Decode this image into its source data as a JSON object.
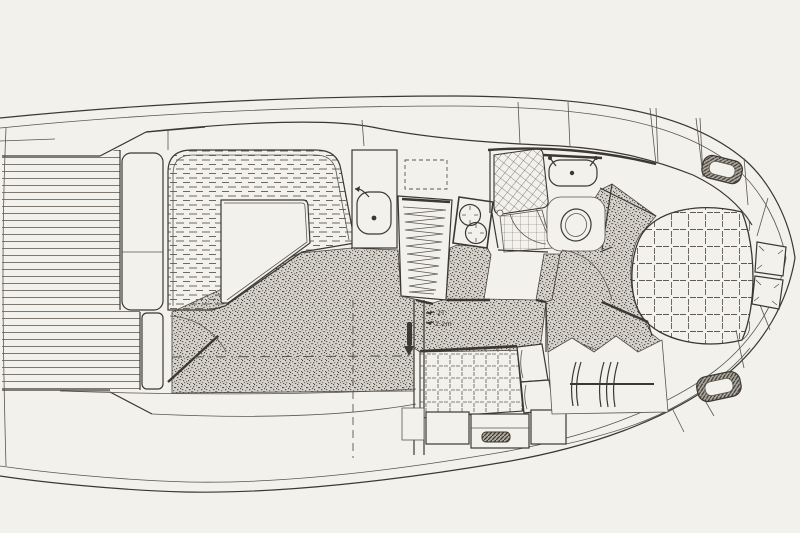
{
  "meta": {
    "alt": "Hand-drawn overhead interior deck plan of a motor yacht",
    "drawing_style": "black ink line drawing on off-white paper"
  },
  "annotations": {
    "line1": "2T",
    "line2": "2.2m"
  },
  "colors": {
    "paper": "#f3f1ec",
    "ink": "#3b3833",
    "ink-soft": "#5a564f",
    "line-light": "#6f6b62",
    "carpet-base": "#d6d3cc",
    "carpet-dot": "#57534b",
    "hatch-bg": "#b0aaa0"
  },
  "features": [
    "hull-outline",
    "rubrail-line",
    "aft-deck-teak",
    "aft-deck-lockers",
    "transom-steps",
    "salon-carpet",
    "salon-settee",
    "salon-table",
    "salon-entry-door",
    "galley-sink-unit",
    "galley-sink",
    "galley-faucet",
    "galley-counter",
    "galley-stove",
    "overhead-hatch-dashed",
    "companionway-handle",
    "head-shower",
    "head-tile-floor",
    "head-sink",
    "head-faucets",
    "head-toilet",
    "head-door",
    "passage-carpet",
    "forward-cabin-carpet",
    "forward-cabin-bed",
    "forward-cabin-pillows",
    "deck-hatch-forward-top",
    "deck-hatch-forward-bottom",
    "guest-berth",
    "guest-pillows",
    "guest-cabinets",
    "cabinet-vent",
    "hanging-locker",
    "clothes-hangers",
    "section-dash-vertical",
    "section-dash-horizontal",
    "dimension-note",
    "window-mullions",
    "bow-panel-lines"
  ]
}
